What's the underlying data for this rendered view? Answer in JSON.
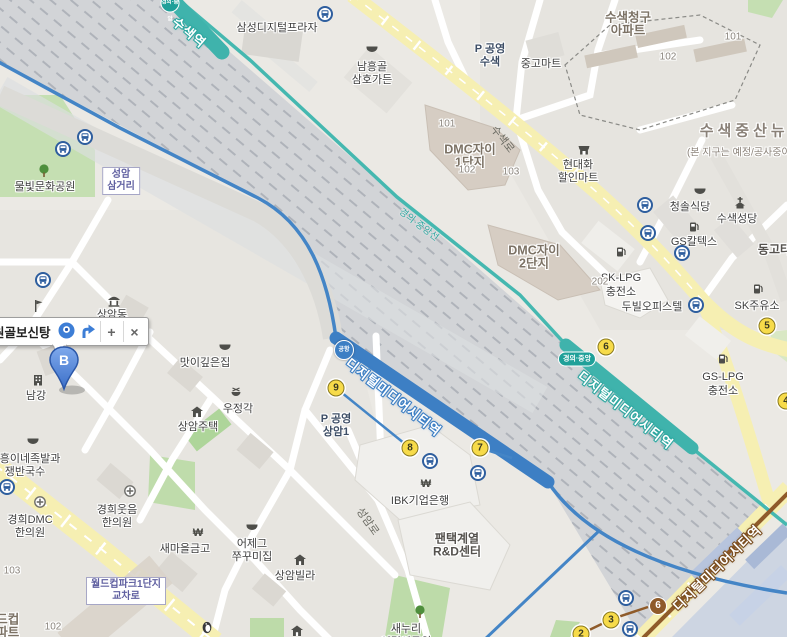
{
  "callout": {
    "title": "원골보신탕",
    "zoom_in_label": "+",
    "close_label": "×"
  },
  "marker_b": {
    "label": "B"
  },
  "stations": [
    {
      "name": "susaek-station",
      "text": "수색역",
      "x": 181,
      "y": 12,
      "rot": 40,
      "line": "teal",
      "badge": {
        "text": "경의·중앙",
        "x": 170,
        "y": 3,
        "type": "tcircle"
      }
    },
    {
      "name": "dmc-station-arex",
      "text": "디지털미디어시티역",
      "x": 354,
      "y": 353,
      "rot": 38,
      "line": "blue",
      "badge": {
        "text": "공항",
        "x": 344,
        "y": 350,
        "type": "bcircle"
      }
    },
    {
      "name": "dmc-station-gyeongui",
      "text": "디지털미디어시티역",
      "x": 586,
      "y": 366,
      "rot": 38,
      "line": "teal",
      "badge": {
        "text": "경의·중앙",
        "x": 577,
        "y": 359,
        "type": "tpill"
      }
    },
    {
      "name": "dmc-station-line6",
      "text": "디지털미디어시티역",
      "x": 668,
      "y": 601,
      "rot": -44,
      "line": "brown",
      "badge": {
        "text": "6",
        "x": 658,
        "y": 606,
        "type": "brcircle"
      }
    }
  ],
  "road_labels": [
    {
      "text": "수색로",
      "x": 500,
      "y": 122,
      "rot": 52,
      "cls": ""
    },
    {
      "text": "성암로",
      "x": 366,
      "y": 504,
      "rot": 55,
      "cls": ""
    },
    {
      "text": "경의·중앙선",
      "x": 405,
      "y": 204,
      "rot": 37,
      "cls": "teal"
    }
  ],
  "boxed_labels": [
    {
      "name": "seongam-samgeori",
      "lines": [
        "성암",
        "삼거리"
      ],
      "x": 121,
      "y": 181
    },
    {
      "name": "worldcuppark-intersection",
      "lines": [
        "월드컵파크1단지",
        "교차로"
      ],
      "x": 126,
      "y": 591
    }
  ],
  "pois": [
    {
      "name": "samsung-digital-plaza",
      "lines": [
        "삼성디지털프라자"
      ],
      "x": 277,
      "y": 27
    },
    {
      "name": "namheunggol-samhogarden",
      "lines": [
        "남흥골",
        "삼호가든"
      ],
      "x": 372,
      "y": 66,
      "icon": "food",
      "ix": 372,
      "iy": 49
    },
    {
      "name": "parking-susaek",
      "lines": [
        "P 공영",
        "수색"
      ],
      "x": 490,
      "y": 48,
      "cls": "parking"
    },
    {
      "name": "junggo-mart",
      "lines": [
        "중고마트"
      ],
      "x": 541,
      "y": 63
    },
    {
      "name": "susaek-chunggu-apt",
      "lines": [
        "수색청구",
        "아파트"
      ],
      "x": 628,
      "y": 16,
      "cls": "complex"
    },
    {
      "name": "hyundaehwa-mart",
      "lines": [
        "현대화",
        "할인마트"
      ],
      "x": 578,
      "y": 164,
      "icon": "shop",
      "ix": 584,
      "iy": 150
    },
    {
      "name": "susaek-jeungsan-newtown",
      "lines": [
        "수색중산뉴타운"
      ],
      "x": 762,
      "y": 130,
      "cls": "district"
    },
    {
      "name": "newtown-note",
      "lines": [
        "(본 지구는 예정/공사중이므로"
      ],
      "x": 748,
      "y": 151,
      "cls": "note"
    },
    {
      "name": "cheongsol-restaurant",
      "lines": [
        "청솔식당"
      ],
      "x": 690,
      "y": 206,
      "icon": "food",
      "ix": 700,
      "iy": 191
    },
    {
      "name": "susaek-cathedral",
      "lines": [
        "수색성당"
      ],
      "x": 737,
      "y": 218,
      "icon": "church",
      "ix": 740,
      "iy": 203
    },
    {
      "name": "gs-caltex",
      "lines": [
        "GS칼텍스"
      ],
      "x": 694,
      "y": 241,
      "icon": "gas",
      "ix": 694,
      "iy": 227
    },
    {
      "name": "donggo-town",
      "lines": [
        "동고타운"
      ],
      "x": 780,
      "y": 249,
      "cls": "big"
    },
    {
      "name": "sk-lpg",
      "lines": [
        "SK-LPG",
        "충전소"
      ],
      "x": 621,
      "y": 278,
      "icon": "gas",
      "ix": 621,
      "iy": 252
    },
    {
      "name": "dubil-officetel",
      "lines": [
        "두빌오피스텔"
      ],
      "x": 652,
      "y": 306
    },
    {
      "name": "sk-gas-station",
      "lines": [
        "SK주유소"
      ],
      "x": 757,
      "y": 305,
      "icon": "gas",
      "ix": 758,
      "iy": 289
    },
    {
      "name": "gs-lpg",
      "lines": [
        "GS-LPG",
        "충전소"
      ],
      "x": 723,
      "y": 377,
      "icon": "gas",
      "ix": 723,
      "iy": 359
    },
    {
      "name": "dmc-xi-1danji",
      "lines": [
        "DMC자이",
        "1단지"
      ],
      "x": 470,
      "y": 148,
      "cls": "complex"
    },
    {
      "name": "dmc-xi-2danji",
      "lines": [
        "DMC자이",
        "2단지"
      ],
      "x": 534,
      "y": 249,
      "cls": "complex"
    },
    {
      "name": "mulbit-culture-park",
      "lines": [
        "물빛문화공원"
      ],
      "x": 45,
      "y": 186,
      "icon": "tree",
      "ix": 44,
      "iy": 171
    },
    {
      "name": "sangam-dong",
      "lines": [
        "상암동"
      ],
      "x": 112,
      "y": 314,
      "icon": "gov",
      "ix": 114,
      "iy": 301
    },
    {
      "name": "school-marker",
      "lines": [],
      "icon": "school",
      "ix": 38,
      "iy": 306
    },
    {
      "name": "namgang",
      "lines": [
        "남강"
      ],
      "x": 36,
      "y": 395,
      "icon": "bldg",
      "ix": 38,
      "iy": 380
    },
    {
      "name": "masikgipeunjip",
      "lines": [
        "맛이깊은집"
      ],
      "x": 205,
      "y": 362,
      "icon": "food",
      "ix": 225,
      "iy": 347
    },
    {
      "name": "woojeonggak",
      "lines": [
        "우정각"
      ],
      "x": 238,
      "y": 408,
      "icon": "food2",
      "ix": 236,
      "iy": 393
    },
    {
      "name": "sangam-jutaek",
      "lines": [
        "상암주택"
      ],
      "x": 198,
      "y": 426,
      "icon": "house",
      "ix": 197,
      "iy": 412
    },
    {
      "name": "jiheung-jokbal",
      "lines": [
        "지흥이네족발과",
        "쟁반국수"
      ],
      "x": 25,
      "y": 458,
      "icon": "food",
      "ix": 33,
      "iy": 441
    },
    {
      "name": "kyunghee-dmc-clinic",
      "lines": [
        "경희DMC",
        "한의원"
      ],
      "x": 30,
      "y": 519,
      "icon": "hospital",
      "ix": 40,
      "iy": 502
    },
    {
      "name": "kyunghee-woosum-clinic",
      "lines": [
        "경희웃음",
        "한의원"
      ],
      "x": 117,
      "y": 509,
      "icon": "hospital",
      "ix": 130,
      "iy": 491
    },
    {
      "name": "saemaul-geumgo",
      "lines": [
        "새마을금고"
      ],
      "x": 185,
      "y": 548,
      "icon": "won",
      "ix": 198,
      "iy": 533
    },
    {
      "name": "eojegeu-jjukkumi",
      "lines": [
        "어제그",
        "쭈꾸미집"
      ],
      "x": 252,
      "y": 543,
      "icon": "food",
      "ix": 252,
      "iy": 527
    },
    {
      "name": "sangam-villa",
      "lines": [
        "상암빌라"
      ],
      "x": 295,
      "y": 575,
      "icon": "house",
      "ix": 300,
      "iy": 560
    },
    {
      "name": "house-marker-2",
      "lines": [],
      "icon": "house",
      "ix": 297,
      "iy": 631
    },
    {
      "name": "ibk-bank",
      "lines": [
        "IBK기업은행"
      ],
      "x": 420,
      "y": 500,
      "icon": "won",
      "ix": 426,
      "iy": 484
    },
    {
      "name": "pantech-rnd",
      "lines": [
        "팬택계열",
        "R&D센터"
      ],
      "x": 457,
      "y": 538,
      "cls": "big"
    },
    {
      "name": "saenuri-childrens-park",
      "lines": [
        "새누리",
        "어린이공원"
      ],
      "x": 406,
      "y": 628,
      "icon": "tree",
      "ix": 420,
      "iy": 612
    },
    {
      "name": "parking-sangam1",
      "lines": [
        "P 공영",
        "상암1"
      ],
      "x": 336,
      "y": 418,
      "cls": "parking"
    },
    {
      "name": "worldcuppark-apt",
      "lines": [
        "월드컵",
        "아파트"
      ],
      "x": 2,
      "y": 618,
      "cls": "complex"
    },
    {
      "name": "penguin-marker",
      "lines": [],
      "icon": "penguin",
      "ix": 207,
      "iy": 627
    }
  ],
  "numbers": [
    {
      "text": "101",
      "x": 447,
      "y": 124
    },
    {
      "text": "102",
      "x": 467,
      "y": 170
    },
    {
      "text": "103",
      "x": 511,
      "y": 172
    },
    {
      "text": "202",
      "x": 600,
      "y": 282
    },
    {
      "text": "101",
      "x": 733,
      "y": 37
    },
    {
      "text": "102",
      "x": 668,
      "y": 57
    },
    {
      "text": "103",
      "x": 12,
      "y": 571
    },
    {
      "text": "102",
      "x": 53,
      "y": 627
    }
  ],
  "exits": [
    {
      "n": "9",
      "x": 336,
      "y": 388
    },
    {
      "n": "8",
      "x": 410,
      "y": 448
    },
    {
      "n": "7",
      "x": 480,
      "y": 448
    },
    {
      "n": "6",
      "x": 606,
      "y": 347
    },
    {
      "n": "5",
      "x": 767,
      "y": 326
    },
    {
      "n": "4",
      "x": 786,
      "y": 401
    },
    {
      "n": "3",
      "x": 611,
      "y": 620
    },
    {
      "n": "2",
      "x": 581,
      "y": 634
    }
  ],
  "bus_stops": [
    [
      85,
      137
    ],
    [
      63,
      149
    ],
    [
      43,
      280
    ],
    [
      325,
      14
    ],
    [
      430,
      461
    ],
    [
      478,
      473
    ],
    [
      645,
      205
    ],
    [
      648,
      233
    ],
    [
      682,
      253
    ],
    [
      696,
      305
    ],
    [
      7,
      487
    ],
    [
      626,
      598
    ],
    [
      630,
      629
    ]
  ]
}
